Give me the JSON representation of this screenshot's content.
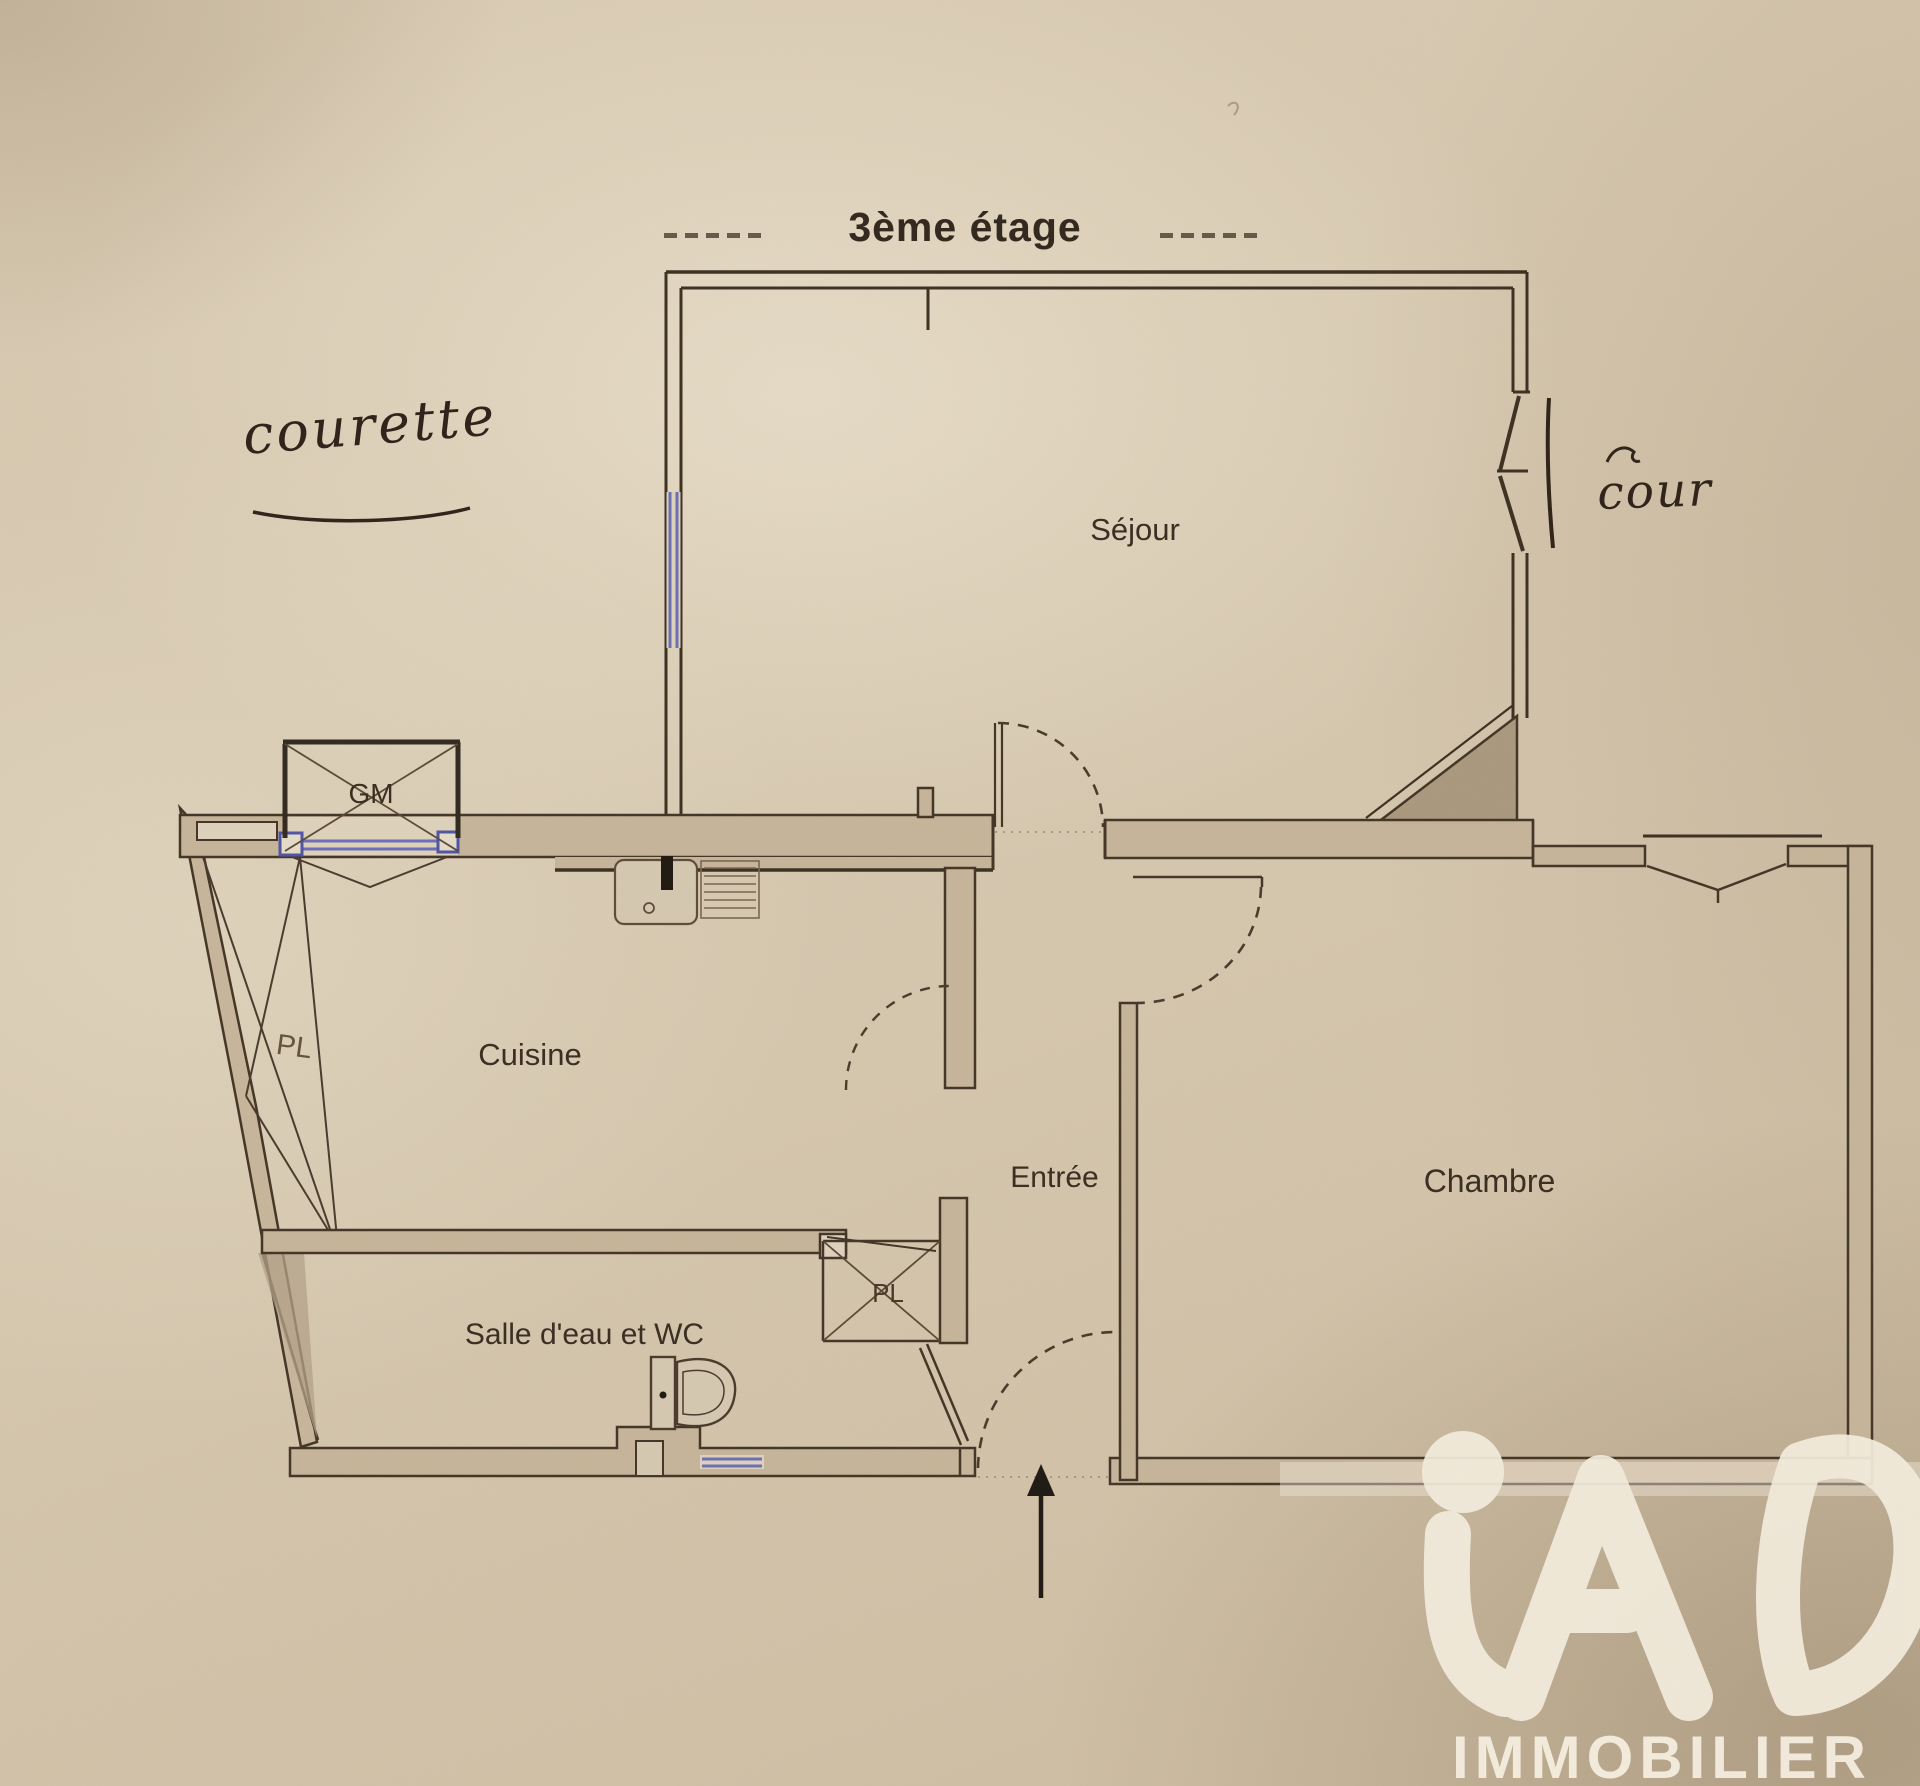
{
  "floor": {
    "title": "3ème étage"
  },
  "rooms": {
    "sejour": "Séjour",
    "cuisine": "Cuisine",
    "entree": "Entrée",
    "chambre": "Chambre",
    "salle_eau": "Salle d'eau et WC"
  },
  "closets": {
    "gm": "GM",
    "pl_west": "PL",
    "pl_entree": "PL"
  },
  "handwritten": {
    "left_annotation": "courette",
    "right_annotation": "cour"
  },
  "logo": {
    "brand": "iAD",
    "subtitle": "IMMOBILIER"
  },
  "colors": {
    "paper": "#d5c7ae",
    "wall_ink": "#443627",
    "heavy_ink": "#332a20",
    "window_blue": "#6b6fb5",
    "logo_cream": "#f4edde"
  }
}
